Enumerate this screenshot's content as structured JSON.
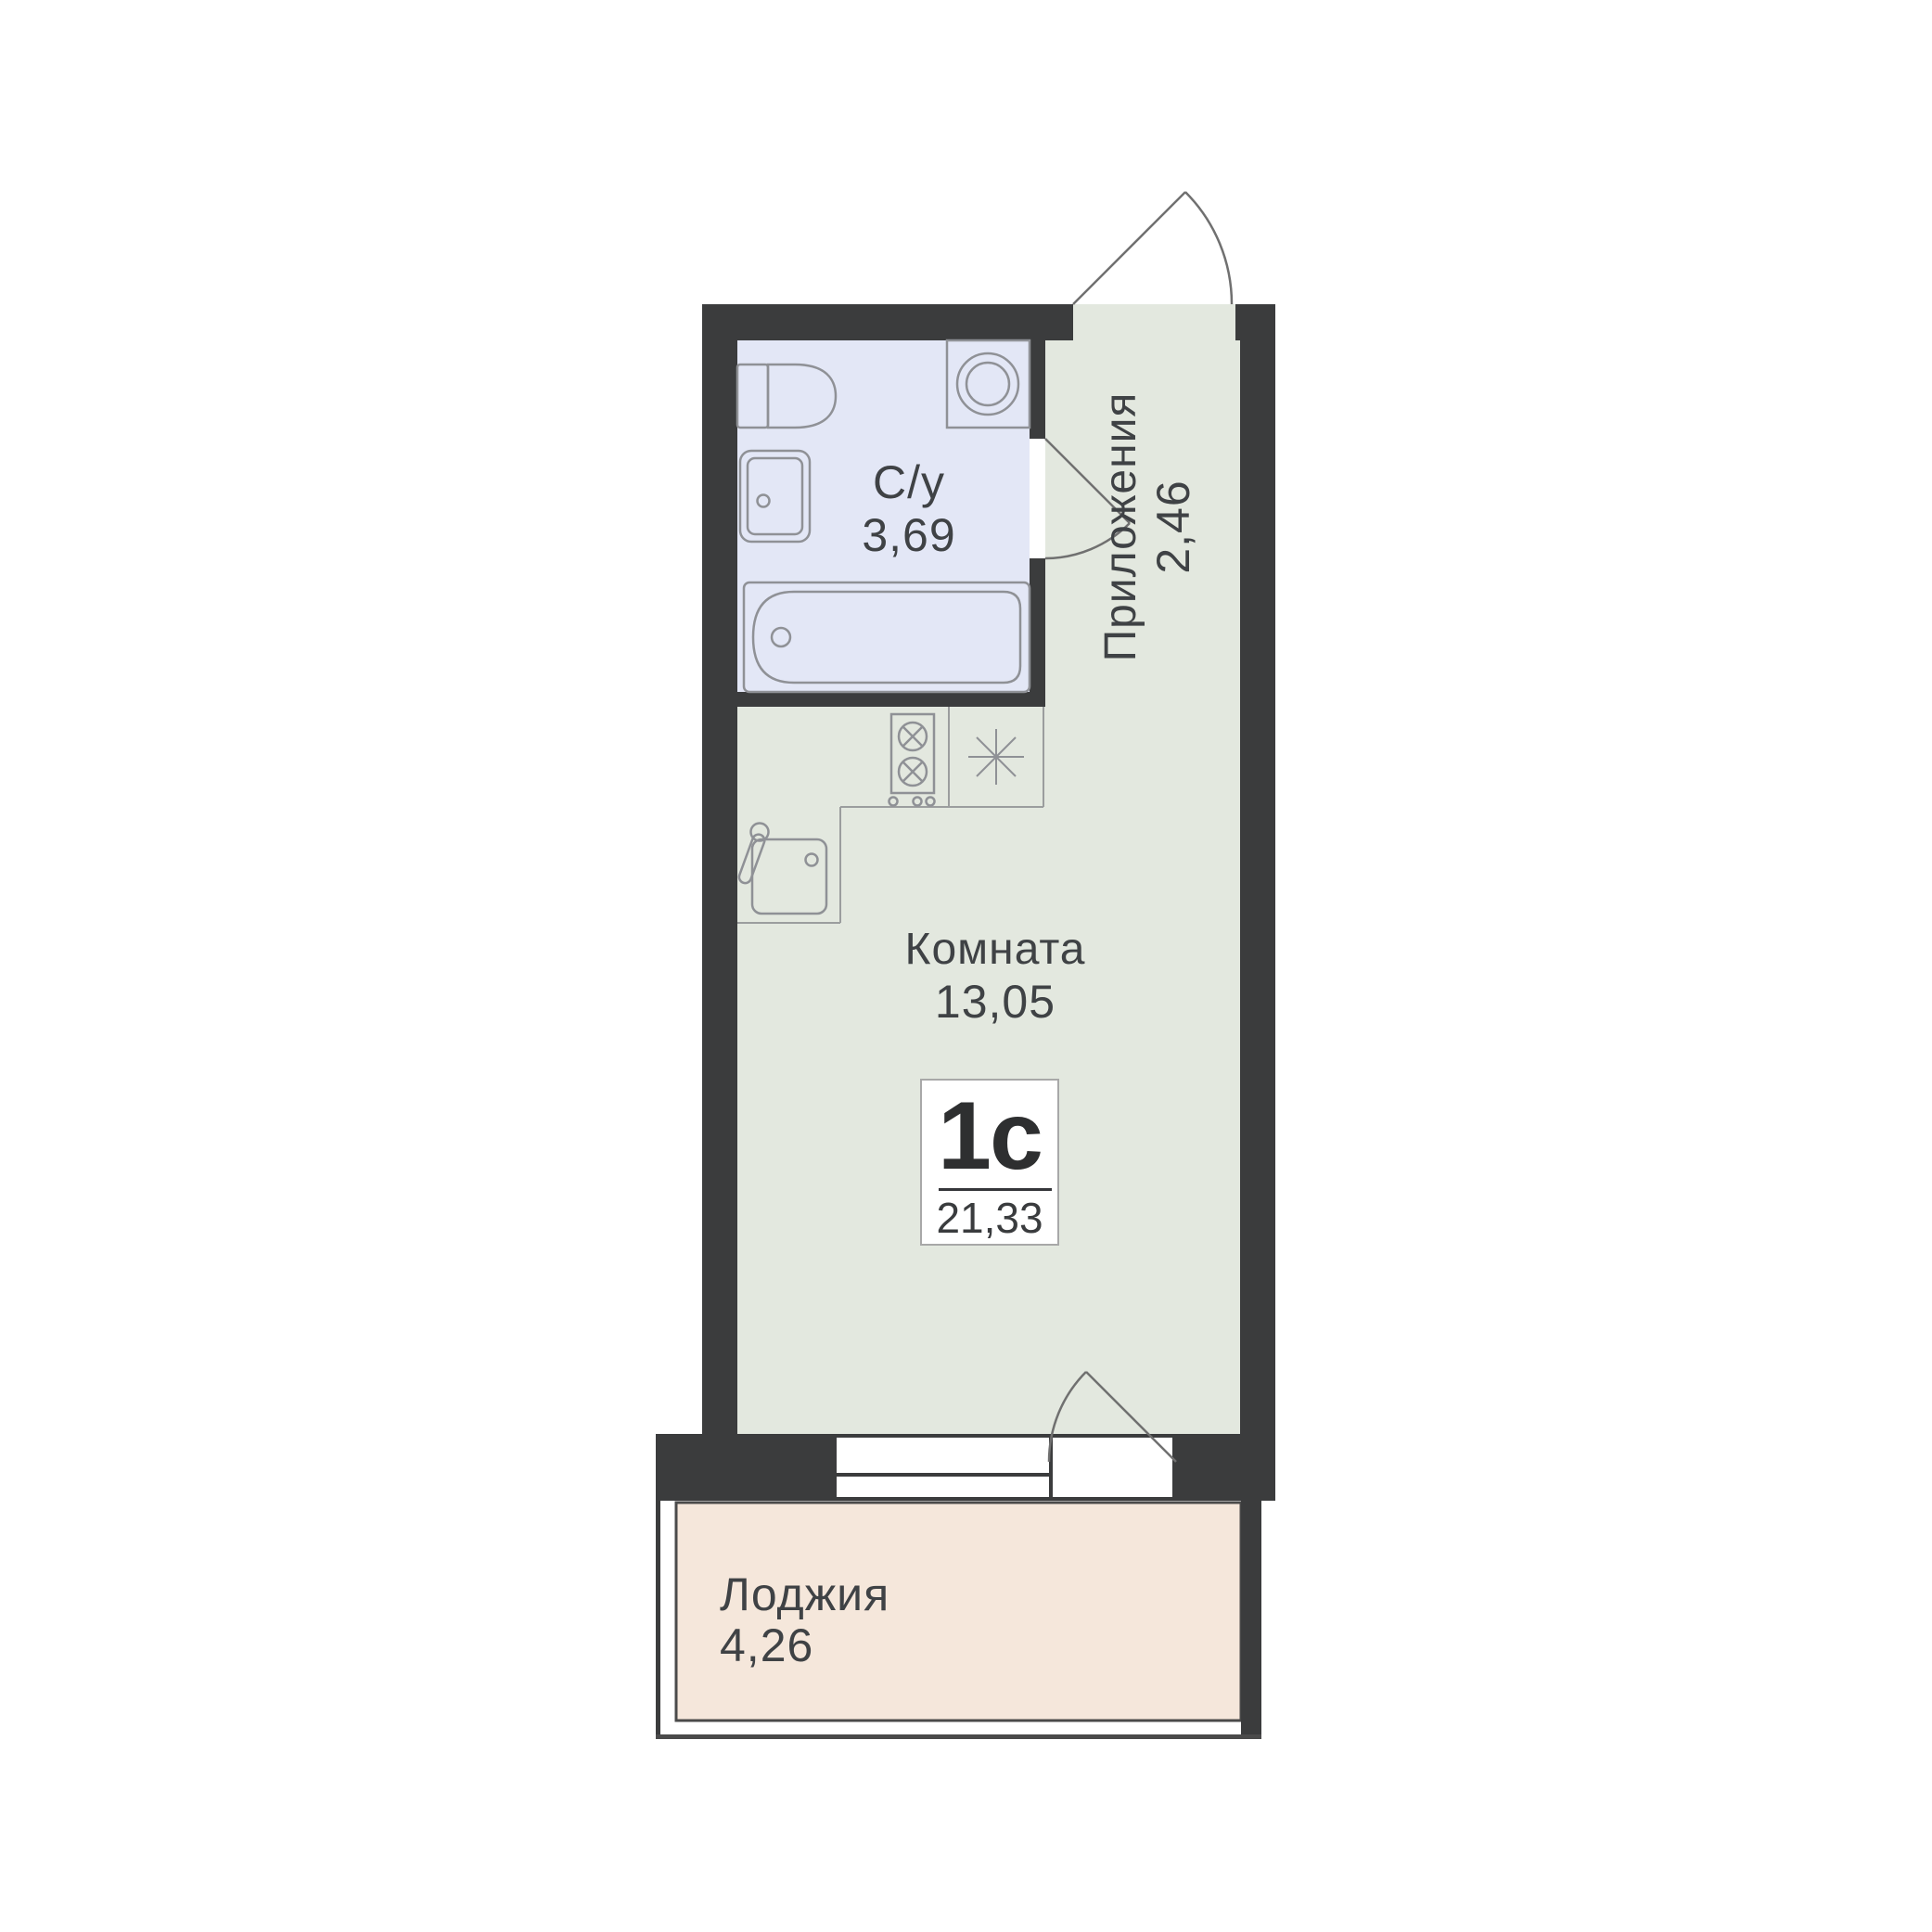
{
  "plan_title": "Floor plan of studio apartment",
  "rooms": {
    "bathroom": {
      "label": "С/у",
      "area": "3,69"
    },
    "hallway": {
      "label": "Приложения",
      "area": "2,46"
    },
    "living": {
      "label": "Комната",
      "area": "13,05"
    },
    "loggia": {
      "label": "Лоджия",
      "area": "4,26"
    }
  },
  "badge": {
    "type": "1с",
    "area": "21,33"
  },
  "colors": {
    "wall": "#3b3c3d",
    "bathroom_fill": "#e3e7f6",
    "living_fill": "#e3e8df",
    "loggia_fill": "#f5e7db",
    "fixture_line": "#8f9196",
    "counter_line": "#9b9d9e",
    "door_line": "#707070",
    "text": "#3f4245",
    "badge_border": "#a8a8a8",
    "background": "#ffffff"
  }
}
